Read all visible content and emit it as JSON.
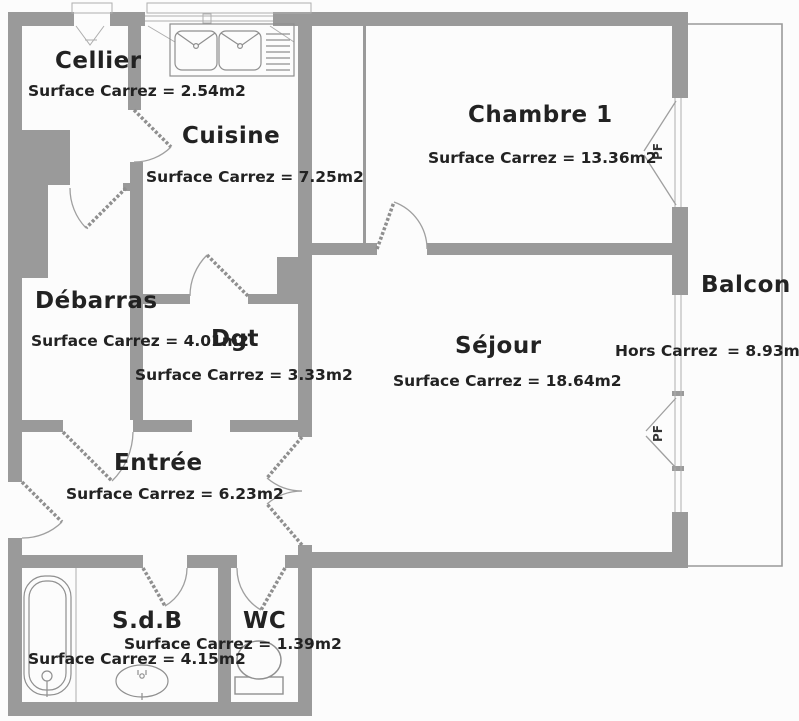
{
  "plan": {
    "type": "apartment-floor-plan",
    "rooms": [
      {
        "id": "cellier",
        "name": "Cellier",
        "area": "Surface Carrez = 2.54m2"
      },
      {
        "id": "cuisine",
        "name": "Cuisine",
        "area": "Surface Carrez = 7.25m2"
      },
      {
        "id": "chambre1",
        "name": "Chambre 1",
        "area": "Surface Carrez = 13.36m2"
      },
      {
        "id": "debarras",
        "name": "Débarras",
        "area": "Surface Carrez = 4.01m2"
      },
      {
        "id": "dgt",
        "name": "Dgt",
        "area": "Surface Carrez = 3.33m2"
      },
      {
        "id": "sejour",
        "name": "Séjour",
        "area": "Surface Carrez = 18.64m2"
      },
      {
        "id": "balcon",
        "name": "Balcon",
        "area_prefix": "Hors Carrez",
        "area_value": "= 8.93m2"
      },
      {
        "id": "entree",
        "name": "Entrée",
        "area": "Surface Carrez = 6.23m2"
      },
      {
        "id": "sdb",
        "name": "S.d.B",
        "area": "Surface Carrez = 4.15m2"
      },
      {
        "id": "wc",
        "name": "WC",
        "area": "Surface Carrez = 1.39m2"
      }
    ],
    "window_label": "PF",
    "colors": {
      "wall": "#9a9a9a",
      "line": "#8f8f8f",
      "text": "#222222",
      "background": "#fcfcfc"
    }
  }
}
